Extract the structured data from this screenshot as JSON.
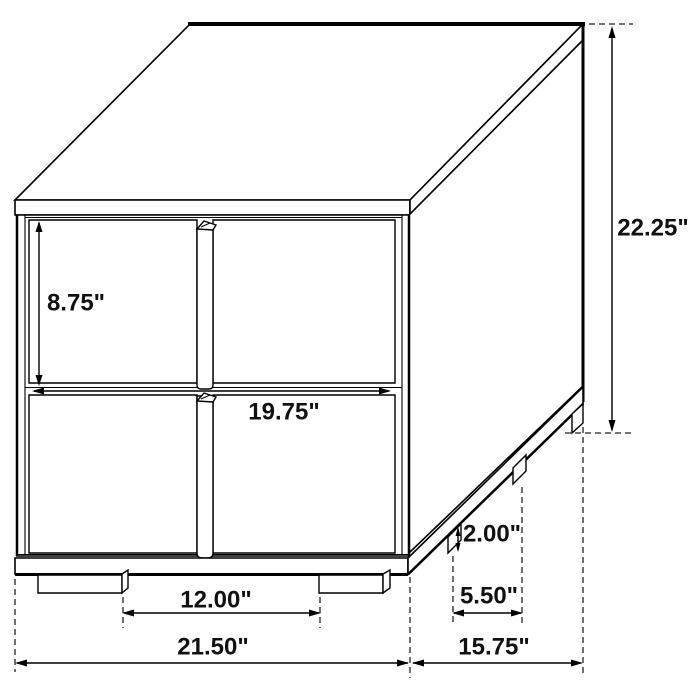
{
  "diagram": {
    "colors": {
      "background": "#ffffff",
      "line": "#000000",
      "dash": "#222222",
      "text": "#111111"
    },
    "dims": {
      "drawer_height": "8.75\"",
      "overall_height": "22.25\"",
      "drawer_width": "19.75\"",
      "leg_gap_front": "12.00\"",
      "overall_width": "21.50\"",
      "overall_depth": "15.75\"",
      "leg_height": "2.00\"",
      "leg_gap_side": "5.50\""
    }
  }
}
